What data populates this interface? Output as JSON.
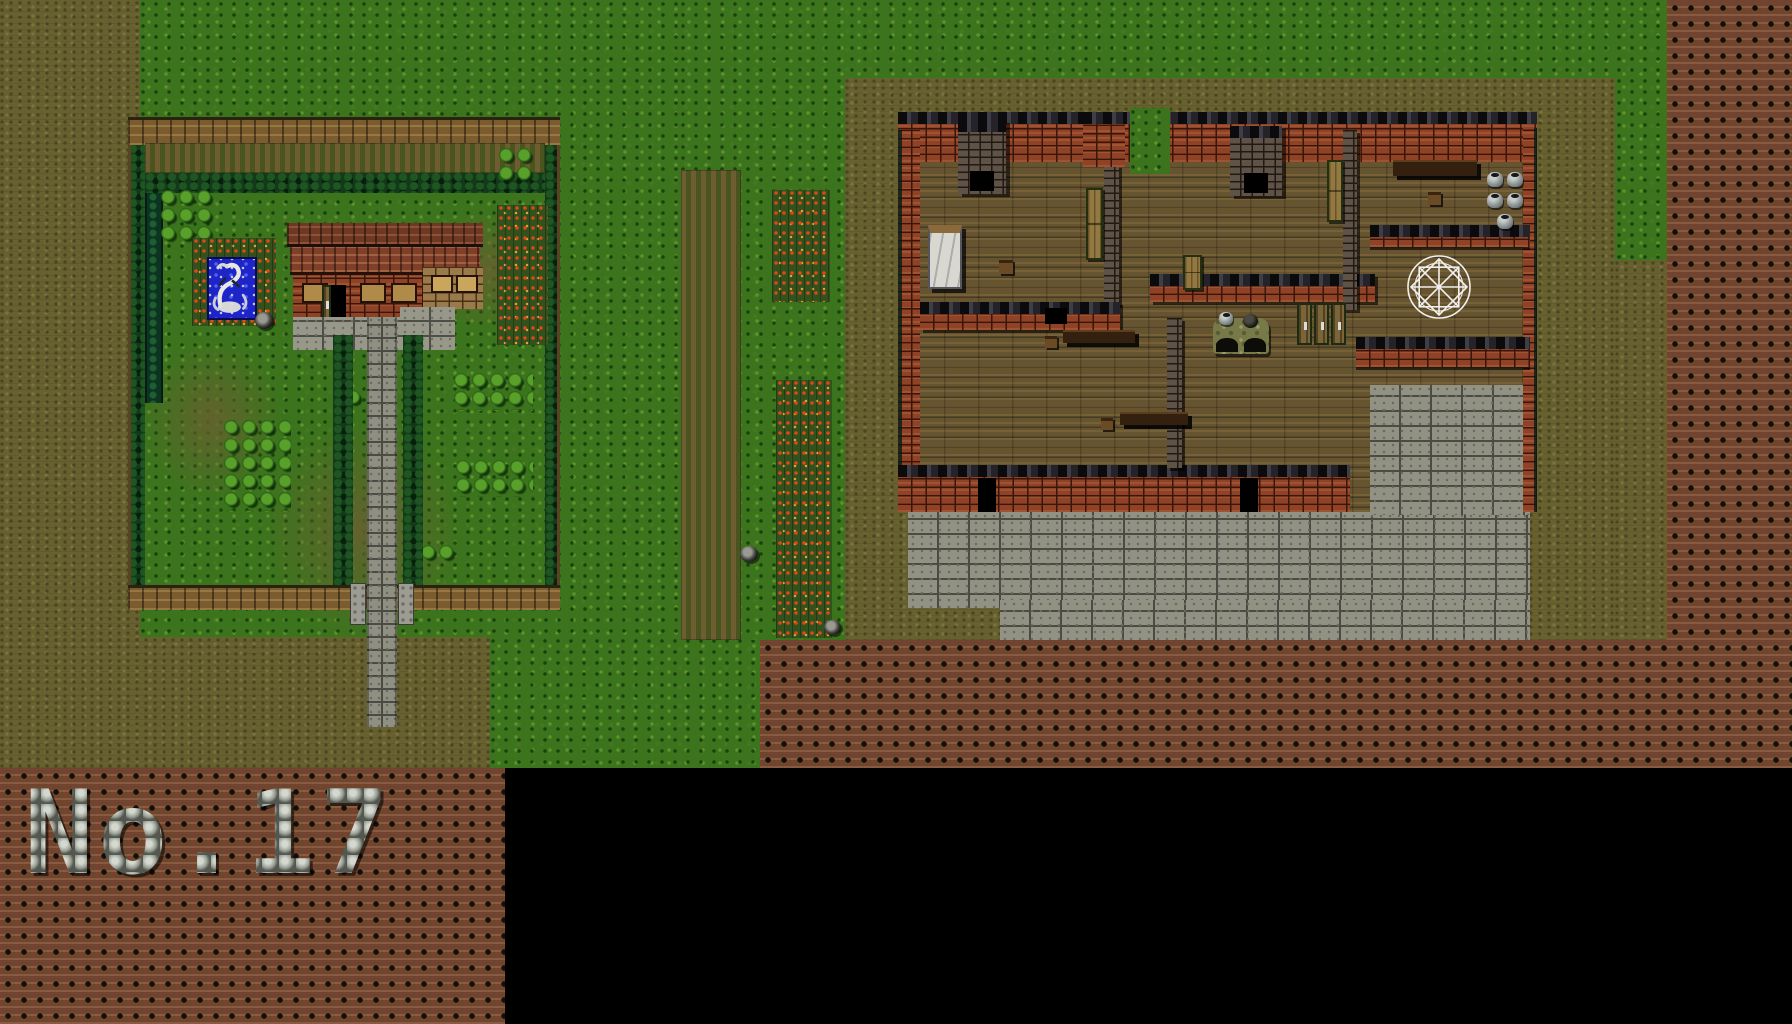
{
  "sheet": {
    "map_label": "No.17",
    "description": "Tile-based RPG map sheet showing an exterior walled garden map and the matching house interior floor plan"
  },
  "palette": {
    "c_grass": "#3c741d",
    "c_dirt": "#67602f",
    "c_reddirt": "#6e4630",
    "c_pond": "#1d25c8",
    "c_void": "#000000",
    "c_brick": "#8f4226",
    "c_stone": "#98988a",
    "c_wood_floor": "#665430",
    "c_roof": "#6e3825",
    "c_hedge": "#123a18",
    "c_flowers": "#e04818"
  },
  "maps": [
    {
      "id": "exterior-garden-map",
      "name": "Walled garden with farmhouse",
      "objects": [
        "wooden perimeter fence",
        "hedge border",
        "tilled field band",
        "pine hedgerow",
        "flower beds",
        "fountain pond",
        "dragon fountain statue",
        "garden well",
        "farmhouse with tiled roof",
        "open door",
        "windows",
        "stone entrance pad",
        "hedge-lined stone walkway",
        "garden bush clusters",
        "flower strips",
        "gate pillars"
      ]
    },
    {
      "id": "interior-floorplan-map",
      "name": "House interior floor plan",
      "objects": [
        "crenellated brick outer walls",
        "wooden plank floors",
        "bed",
        "fireplace chimneys",
        "wall cupboards",
        "long tables",
        "stools",
        "storage jars",
        "stone oven with pots",
        "triple wooden doors",
        "magic summoning circle",
        "stone terrace",
        "black door openings"
      ]
    }
  ],
  "surroundings": {
    "objects": [
      "grass field",
      "tilled furrow strip",
      "flower rows",
      "field wells",
      "packed red earth with stud pattern",
      "black void area",
      "stone number label"
    ]
  }
}
